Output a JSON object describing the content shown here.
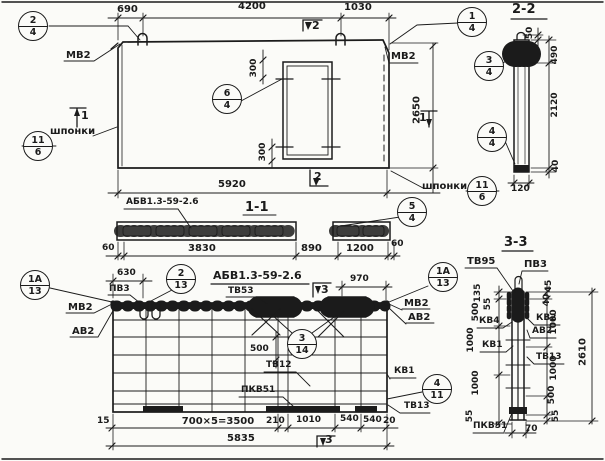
{
  "plan": {
    "dim_690": "690",
    "dim_4200": "4200",
    "dim_1030": "1030",
    "dim_5920": "5920",
    "dim_2650": "2650",
    "dim_300_top": "300",
    "dim_300_bottom": "300",
    "label_mv2_left": "МВ2",
    "label_mv2_right": "МВ2",
    "label_keys_left": "шпонки",
    "label_keys_right": "шпонки",
    "marker_2_top": "2",
    "marker_2_bottom": "2",
    "marker_1_left": "1",
    "marker_1_right": "1",
    "callout_2_4": {
      "num": "2",
      "sheet": "4"
    },
    "callout_1_4": {
      "num": "1",
      "sheet": "4"
    },
    "callout_3_4": {
      "num": "3",
      "sheet": "4"
    },
    "callout_4_4": {
      "num": "4",
      "sheet": "4"
    },
    "callout_5_4": {
      "num": "5",
      "sheet": "4"
    },
    "callout_6_4": {
      "num": "6",
      "sheet": "4"
    },
    "callout_keys_left": {
      "num": "11",
      "sheet": "6"
    },
    "callout_keys_right": {
      "num": "11",
      "sheet": "6"
    }
  },
  "section22": {
    "title": "2-2",
    "dim_50": "50",
    "dim_490": "490",
    "dim_2120": "2120",
    "dim_40": "40",
    "dim_120": "120"
  },
  "section11": {
    "title": "1-1",
    "mark_label": "АБВ1.3-59-2.6",
    "dim_60_left": "60",
    "dim_3830": "3830",
    "dim_890": "890",
    "dim_1200": "1200",
    "dim_60_right": "60"
  },
  "reinforcement": {
    "title": "АБВ1.3-59-2.6",
    "label_pv3": "ПВ3",
    "label_tv53": "ТВ53",
    "label_tv12": "ТВ12",
    "label_pkv51": "ПКВ51",
    "label_kv1": "КВ1",
    "label_tv13": "ТВ13",
    "label_mv2_left": "МВ2",
    "label_av2_left": "АВ2",
    "label_mv2_right": "МВ2",
    "label_av2_right": "АВ2",
    "dim_630": "630",
    "dim_970": "970",
    "dim_500": "500",
    "dim_15": "15",
    "dim_bays": "700×5=3500",
    "dim_210": "210",
    "dim_1010": "1010",
    "dim_540_a": "540",
    "dim_540_b": "540",
    "dim_20": "20",
    "dim_total": "5835",
    "marker_3_top": "3",
    "marker_3_bottom": "3",
    "callout_1a_left": {
      "num": "1А",
      "sheet": "13"
    },
    "callout_2_13": {
      "num": "2",
      "sheet": "13"
    },
    "callout_1a_right": {
      "num": "1А",
      "sheet": "13"
    },
    "callout_3_14": {
      "num": "3",
      "sheet": "14"
    },
    "callout_4_11": {
      "num": "4",
      "sheet": "11"
    }
  },
  "section33": {
    "title": "3-3",
    "label_tv95": "ТВ95",
    "label_pv3": "ПВ3",
    "label_kv4": "КВ4",
    "label_kv1": "КВ1",
    "label_kv2": "КВ2",
    "label_av2": "АВ2",
    "label_tv13": "ТВ13",
    "label_pkv51": "ПКВ51",
    "dim_135": "135",
    "dim_55_top": "55",
    "dim_500_left": "500",
    "dim_1000_left_1": "1000",
    "dim_1000_left_2": "1000",
    "dim_55_bottom": "55",
    "dim_70": "70",
    "dim_45": "45",
    "dim_40": "40",
    "dim_1000_right_1": "1000",
    "dim_1000_right_2": "1000",
    "dim_500_right": "500",
    "dim_55_right": "55",
    "dim_total": "2610"
  }
}
